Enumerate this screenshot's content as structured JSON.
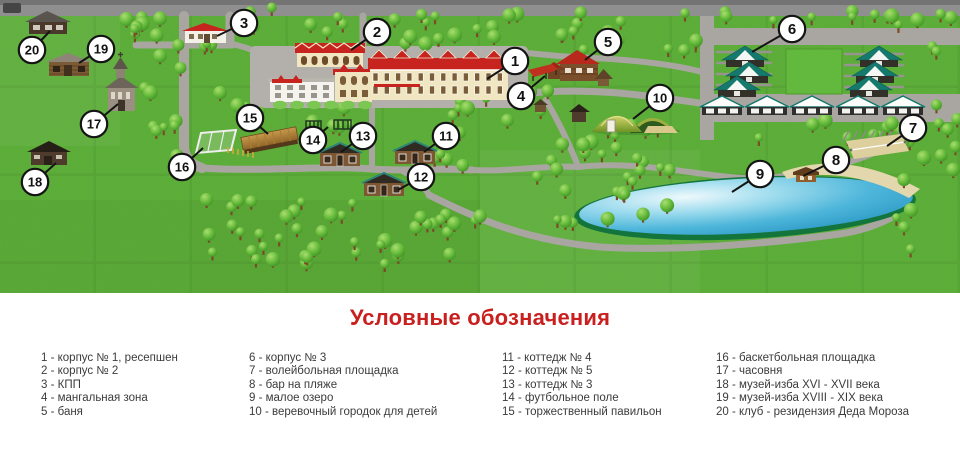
{
  "map": {
    "callouts": [
      {
        "num": "1",
        "cx": 515,
        "cy": 61,
        "tx": 487,
        "ty": 79
      },
      {
        "num": "2",
        "cx": 377,
        "cy": 32,
        "tx": 351,
        "ty": 50
      },
      {
        "num": "3",
        "cx": 244,
        "cy": 23,
        "tx": 217,
        "ty": 36
      },
      {
        "num": "4",
        "cx": 521,
        "cy": 96,
        "tx": 545,
        "ty": 76
      },
      {
        "num": "5",
        "cx": 608,
        "cy": 42,
        "tx": 585,
        "ty": 60
      },
      {
        "num": "6",
        "cx": 792,
        "cy": 29,
        "tx": 752,
        "ty": 52
      },
      {
        "num": "7",
        "cx": 913,
        "cy": 128,
        "tx": 887,
        "ty": 146
      },
      {
        "num": "8",
        "cx": 836,
        "cy": 160,
        "tx": 803,
        "ty": 176
      },
      {
        "num": "9",
        "cx": 760,
        "cy": 174,
        "tx": 732,
        "ty": 192
      },
      {
        "num": "10",
        "cx": 660,
        "cy": 98,
        "tx": 633,
        "ty": 119
      },
      {
        "num": "11",
        "cx": 446,
        "cy": 136,
        "tx": 424,
        "ty": 152
      },
      {
        "num": "12",
        "cx": 421,
        "cy": 177,
        "tx": 398,
        "ty": 190
      },
      {
        "num": "13",
        "cx": 363,
        "cy": 136,
        "tx": 341,
        "ty": 152
      },
      {
        "num": "14",
        "cx": 313,
        "cy": 140,
        "tx": 328,
        "ty": 127
      },
      {
        "num": "15",
        "cx": 250,
        "cy": 118,
        "tx": 268,
        "ty": 134
      },
      {
        "num": "16",
        "cx": 182,
        "cy": 167,
        "tx": 203,
        "ty": 148
      },
      {
        "num": "17",
        "cx": 94,
        "cy": 124,
        "tx": 118,
        "ty": 104
      },
      {
        "num": "18",
        "cx": 35,
        "cy": 182,
        "tx": 56,
        "ty": 163
      },
      {
        "num": "19",
        "cx": 101,
        "cy": 49,
        "tx": 79,
        "ty": 63
      },
      {
        "num": "20",
        "cx": 32,
        "cy": 50,
        "tx": 50,
        "ty": 31
      }
    ]
  },
  "legend": {
    "title": "Условные обозначения",
    "columns": [
      [
        "1 - корпус № 1, ресепшен",
        "2 - корпус № 2",
        "3 - КПП",
        "4 - мангальная зона",
        "5 - баня"
      ],
      [
        "6 - корпус № 3",
        "7 - волейбольная площадка",
        "8 - бар на пляже",
        "9 - малое озеро",
        "10 - веревочный городок для детей"
      ],
      [
        "11 - коттедж № 4",
        "12 - коттедж № 5",
        "13 - коттедж № 3",
        "14 - футбольное поле",
        "15 - торжественный павильон"
      ],
      [
        "16 - баскетбольная площадка",
        "17 - часовня",
        "18 - музей-изба XVI - XVII века",
        "19 - музей-изба XVIII - XIX века",
        "20 - клуб - резидензия Деда Мороза"
      ]
    ]
  },
  "colors": {
    "legend_title": "#c9201f",
    "callout_stroke": "#141414",
    "callout_fill": "#ffffff",
    "grass": "#5cad37",
    "road": "#a9a6a1",
    "lake_water": "#3fa8d0",
    "roof_red": "#c8241f",
    "roof_teal": "#157a6d"
  }
}
